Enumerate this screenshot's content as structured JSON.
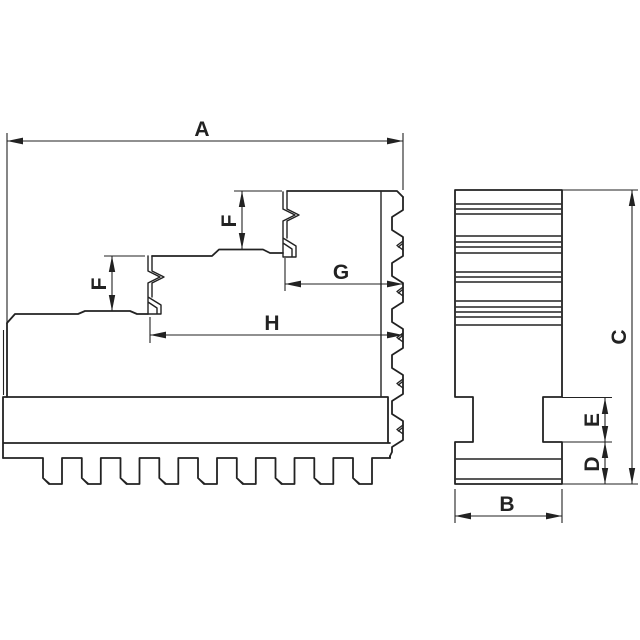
{
  "drawing": {
    "title": "stepped-chuck-jaw-two-view-technical-drawing",
    "background": "#ffffff",
    "line_color": "#222222",
    "labels": {
      "A": "A",
      "B": "B",
      "C": "C",
      "D": "D",
      "E": "E",
      "F_upper": "F",
      "F_lower": "F",
      "G": "G",
      "H": "H"
    },
    "front_view": {
      "groove_lines_y": [
        204,
        209,
        214,
        236,
        242,
        247,
        253,
        272,
        277,
        282,
        301,
        307,
        312,
        317,
        325
      ],
      "flange_lines_y": [
        459,
        479
      ],
      "left_x": 455.8,
      "right_x": 561.2
    },
    "side_view": {
      "teeth": {
        "start_x": 43,
        "pitch": 38.75,
        "tooth_width": 19,
        "count": 9,
        "top_y": 458,
        "bottom_y": 484,
        "chamfer": 6,
        "shelf_left_x": 3,
        "shelf_right_x": 390
      }
    }
  }
}
